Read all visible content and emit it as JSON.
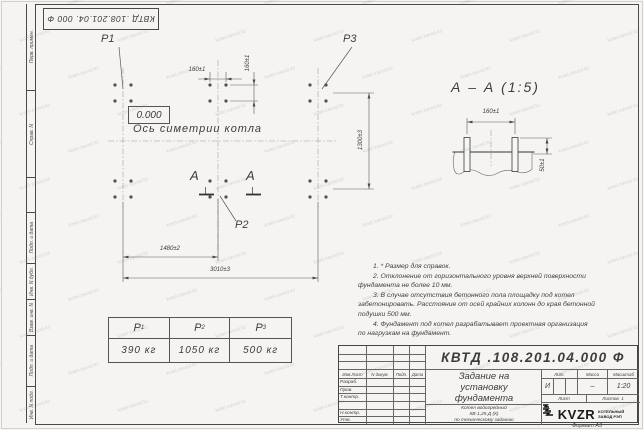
{
  "watermark": "kotel-zavod.kz",
  "stamp": {
    "doc_number": "КВТД .108.201.04. 000 Ф"
  },
  "sidebar": {
    "items": [
      "Перв. примен.",
      "Справ. N",
      "Подп. и дата",
      "Инв. N дубл.",
      "Взам. инв. N",
      "Подп. и дата",
      "Инв. N подл."
    ]
  },
  "plan": {
    "p1": "P1",
    "p2": "P2",
    "p3": "P3",
    "elevation": "0.000",
    "axis_label": "Ось симетрии котла",
    "dim_bolt_h": "160±1",
    "dim_bolt_v": "160±1",
    "dim_width": "1300±3",
    "dim_span1": "1480±2",
    "dim_span2": "3010±3",
    "section_letter": "А"
  },
  "section": {
    "title": "А – А (1:5)",
    "dim_spacing": "160±1",
    "dim_height": "50±1"
  },
  "notes": [
    "1. * Размер для справок.",
    "2. Отклонение от горизонтального уровня верхней поверхности",
    "фундамента не более 10 мм.",
    "3. В случае отсутствия бетонного пола площадку под котел",
    "забетонировать. Расстояние от осей крайних колонн до края бетонной",
    "подушки 500 мм.",
    "4. Фундамент под котел разрабатывает проектная организация",
    "по нагрузкам на фундамент."
  ],
  "load_table": {
    "headers": [
      {
        "base": "P",
        "sub": "1"
      },
      {
        "base": "P",
        "sub": "2"
      },
      {
        "base": "P",
        "sub": "3"
      }
    ],
    "values": [
      "390 кг",
      "1050 кг",
      "500 кг"
    ]
  },
  "title_block": {
    "doc_number": "КВТД .108.201.04.000 Ф",
    "title_lines": [
      "Задание на",
      "установку",
      "фундамента"
    ],
    "subtitle_lines": [
      "Котел водогрейный",
      "КВ-1,25 Д (К)",
      "по техническому заданию"
    ],
    "sig_header": {
      "col1": "Изм.Лист",
      "col2": "N докум.",
      "col3": "Подп.",
      "col4": "Дата"
    },
    "sig_rows": [
      "Разраб.",
      "Пров.",
      "Т.контр.",
      "",
      "Н.контр.",
      "Утв."
    ],
    "lit_header": "Лит.",
    "mass_header": "Масса",
    "scale_header": "Масштаб",
    "lit_value": "И",
    "mass_value": "–",
    "scale_value": "1:20",
    "sheet_label": "Лист",
    "sheets_label": "Листов",
    "sheets_value": "1",
    "logo_text": "KVZR",
    "company_line1": "КОТЕЛЬНЫЙ",
    "company_line2": "ЗАВОД РЭП",
    "format_label": "Формат А3"
  }
}
